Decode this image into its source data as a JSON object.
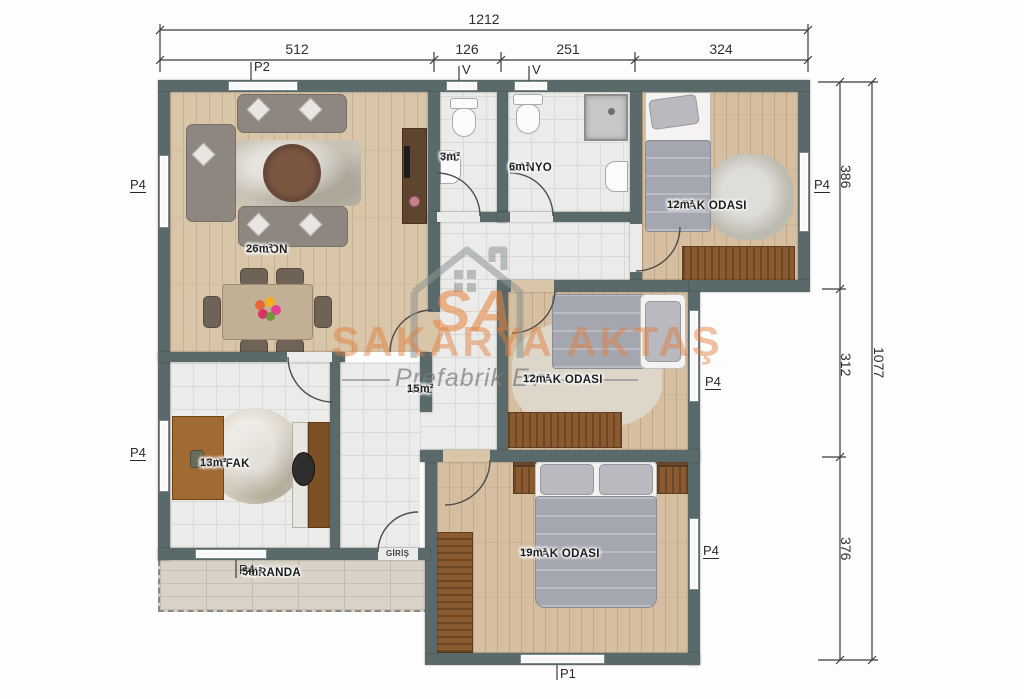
{
  "title": "Prefabrik ev kat planı",
  "colors": {
    "wall": "#5a6a6a",
    "wood_floor": "#d9c5a8",
    "tile_floor": "#ebebe9",
    "veranda_floor": "#d8d3c6",
    "accent_orange": "#e07e3c",
    "furniture_brown": "#8a5a30"
  },
  "dimensions": {
    "top": {
      "total": "1212",
      "segments": [
        {
          "label": "512"
        },
        {
          "label": "126"
        },
        {
          "label": "251"
        },
        {
          "label": "324"
        }
      ]
    },
    "right": {
      "total": "1077",
      "segments": [
        {
          "label": "386"
        },
        {
          "label": "312"
        },
        {
          "label": "376"
        }
      ]
    }
  },
  "rooms": {
    "salon": {
      "name": "SALON",
      "area": "26m²"
    },
    "wc": {
      "name": "WC",
      "area": "3m²"
    },
    "banyo": {
      "name": "BANYO",
      "area": "6m²"
    },
    "bedroom_top": {
      "name": "YATAK ODASI",
      "area": "12m²"
    },
    "bedroom_middle": {
      "name": "YATAK ODASI",
      "area": "12m²"
    },
    "bedroom_bottom": {
      "name": "YATAK ODASI",
      "area": "19m²"
    },
    "hol": {
      "name": "HOL",
      "area": "15m²"
    },
    "mutfak": {
      "name": "MUTFAK",
      "area": "13m²"
    },
    "veranda": {
      "name": "VERANDA",
      "area": "5m²"
    }
  },
  "openings": {
    "p2_top_salon": "P2",
    "v_wc": "V",
    "v_banyo": "V",
    "p4_left_salon": "P4",
    "p4_left_mutfak": "P4",
    "p4_right_bedroom_top": "P4",
    "p4_bedroom_middle": "P4",
    "p4_bedroom_bottom": "P4",
    "p4_veranda": "P4",
    "p1_bottom": "P1",
    "entrance": "GİRİŞ"
  },
  "watermark": {
    "logo_text": "SA",
    "brand": "SAKARYA AKTAŞ",
    "tagline": "Prefabrik Ev"
  }
}
